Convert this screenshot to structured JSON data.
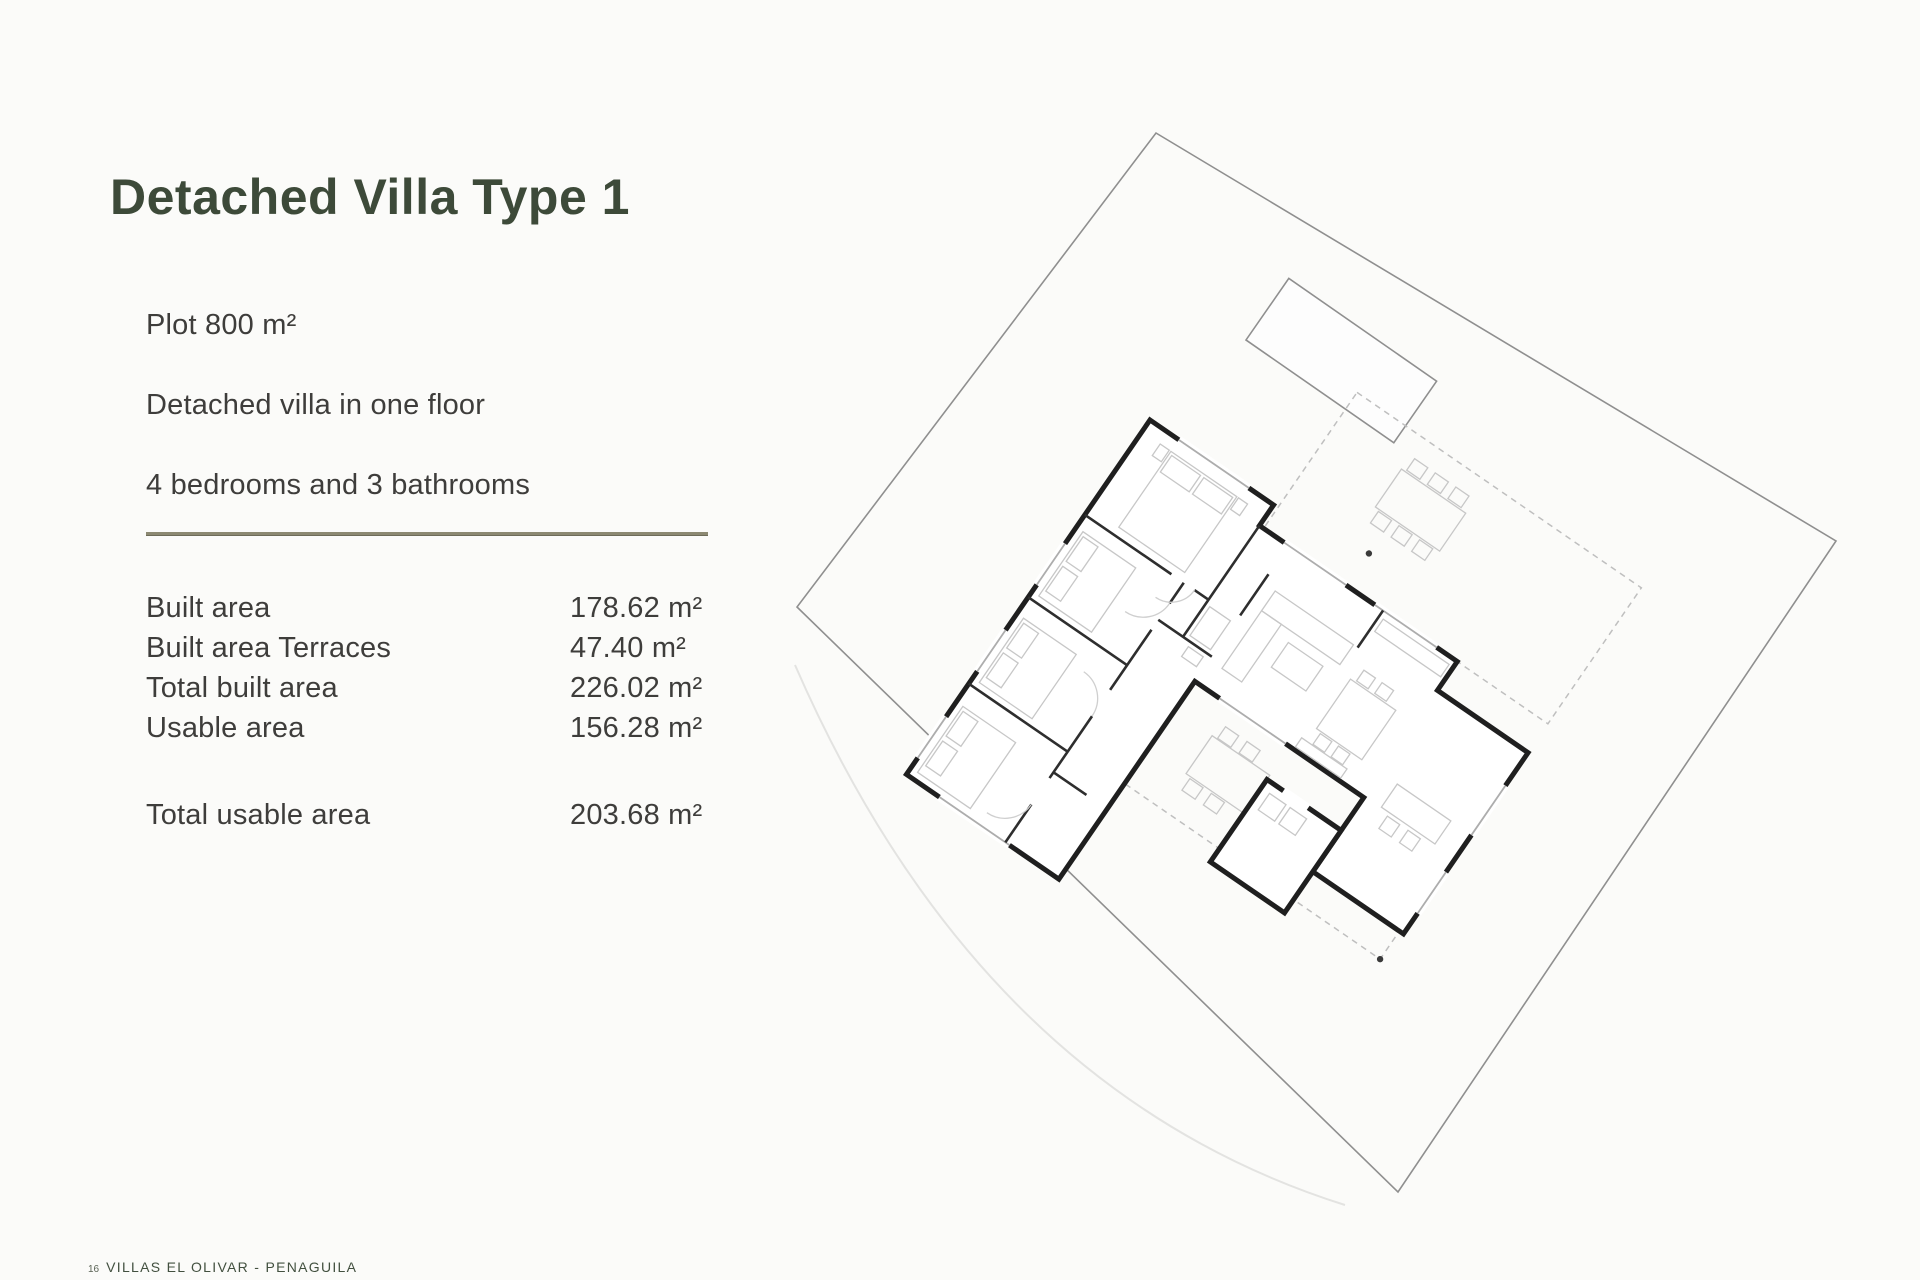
{
  "page": {
    "title": "Detached Villa Type 1",
    "background_color": "#fbfbf9",
    "title_color": "#3d4a39",
    "divider_color": "#8c8972",
    "body_text_color": "#3e3d3b"
  },
  "specs": {
    "items": [
      "Plot 800 m²",
      "Detached villa in one floor",
      "4 bedrooms and 3 bathrooms"
    ]
  },
  "areas": {
    "rows": [
      {
        "label": "Built area",
        "value": "178.62 m²"
      },
      {
        "label": "Built area Terraces",
        "value": "47.40 m²"
      },
      {
        "label": "Total built area",
        "value": "226.02 m²"
      },
      {
        "label": "Usable area",
        "value": "156.28 m²"
      }
    ],
    "total": {
      "label": "Total usable area",
      "value": "203.68 m²"
    }
  },
  "footer": {
    "page_number": "16",
    "text": "VILLAS EL OLIVAR - PENAGUILA"
  },
  "floor_plan": {
    "type": "architectural site plan, rotated ~34 degrees",
    "elements": [
      "plot-boundary",
      "swimming-pool",
      "villa-walls",
      "terrace-dashed-outline",
      "furniture",
      "survey-dots",
      "terrain-curve"
    ],
    "wall_color": "#1f1f1f",
    "line_color": "#8f8f8f",
    "furniture_color": "#c7c7c7"
  }
}
